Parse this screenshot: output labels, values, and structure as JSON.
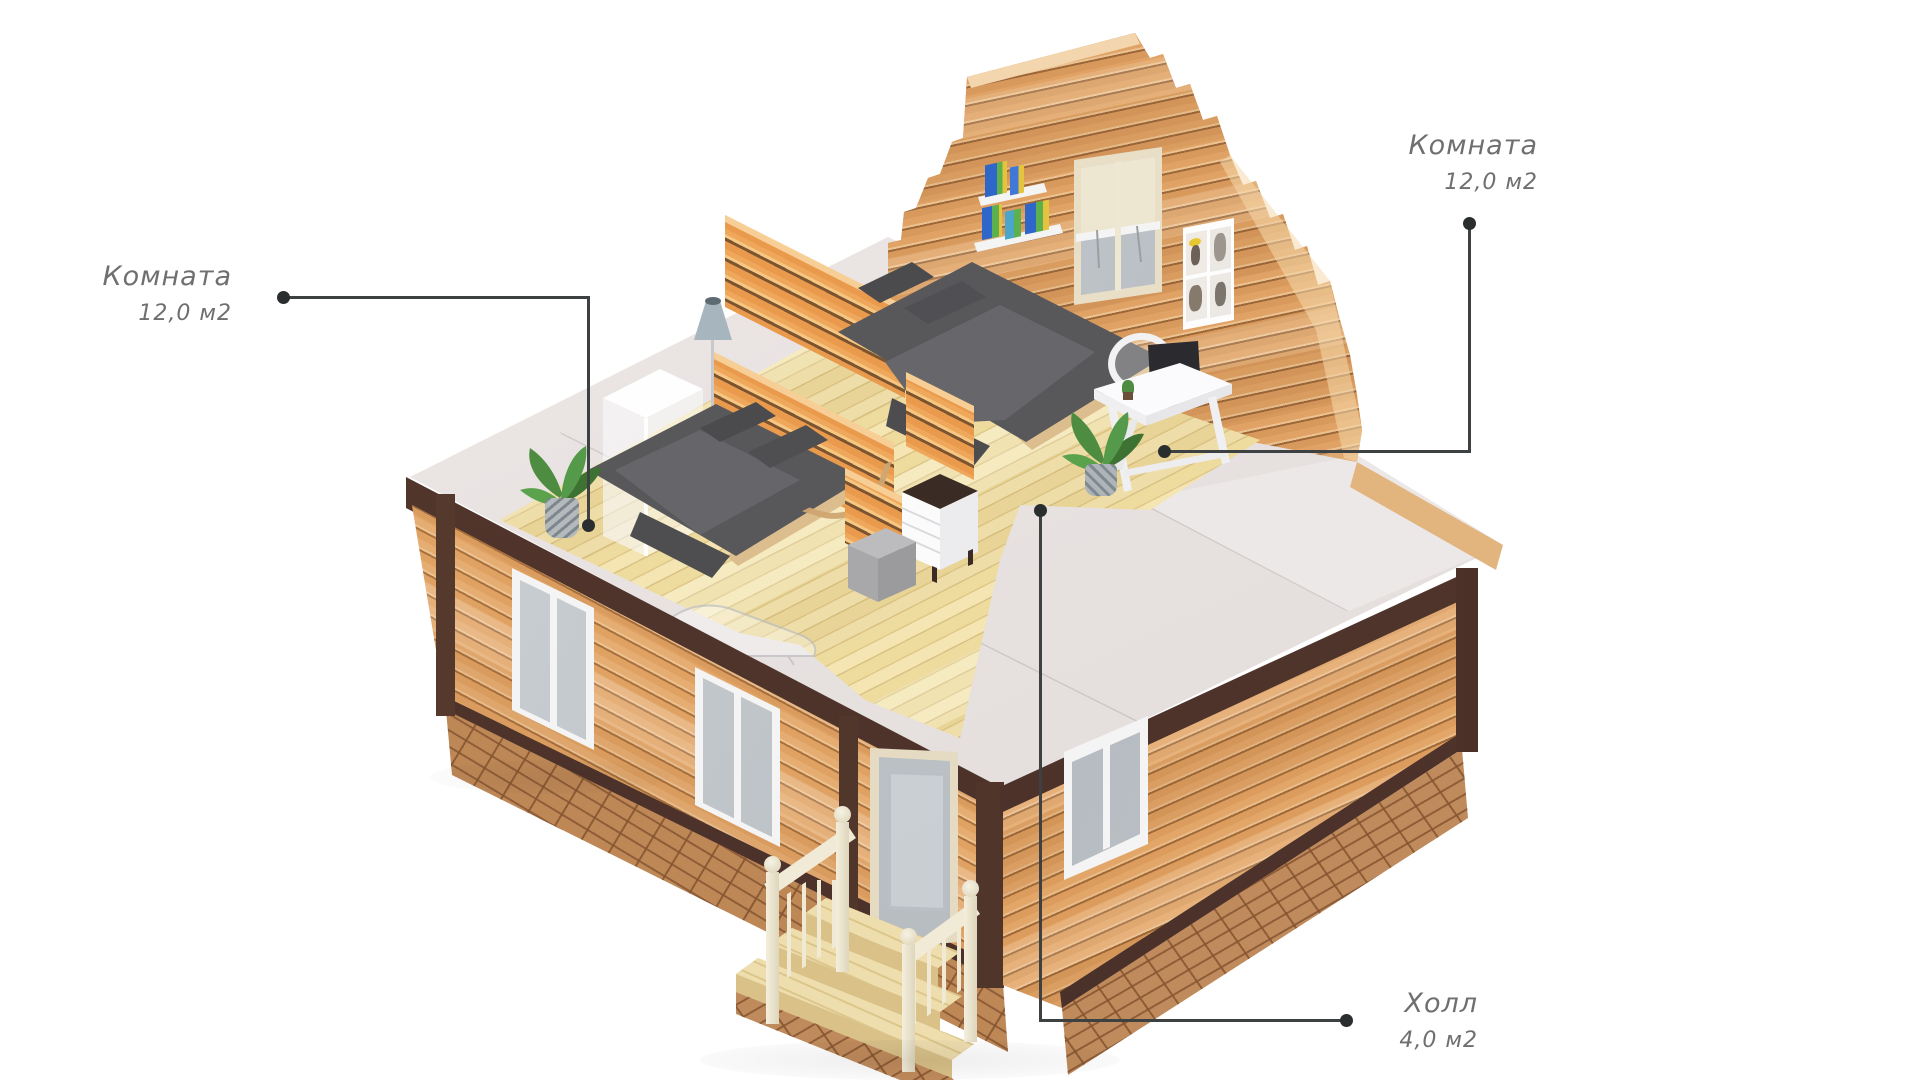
{
  "labels": {
    "room_left": {
      "title": "Комната",
      "area": "12,0 м2"
    },
    "room_right": {
      "title": "Комната",
      "area": "12,0 м2"
    },
    "hall": {
      "title": "Холл",
      "area": "4,0 м2"
    }
  },
  "palette": {
    "background": "#ffffff",
    "label_text": "#6f6f6f",
    "leader_line": "#3e4141",
    "wall_wood": "#e5ad72",
    "wood_gap": "#a8713d",
    "trim_brown": "#4e352b",
    "brick": "#bd8756",
    "mortar": "#8f5e38",
    "ceiling_gray": "#e7e2e1",
    "floor_wood": "#f1e0a9",
    "bedding_gray": "#58585b",
    "furniture_white": "#fafafa",
    "railing_cream": "#f1ead6",
    "plant_green": "#4e8c41",
    "books_blue": "#2f66c9",
    "books_green": "#5cb04e",
    "lamp_shade": "#9fb0ba"
  }
}
